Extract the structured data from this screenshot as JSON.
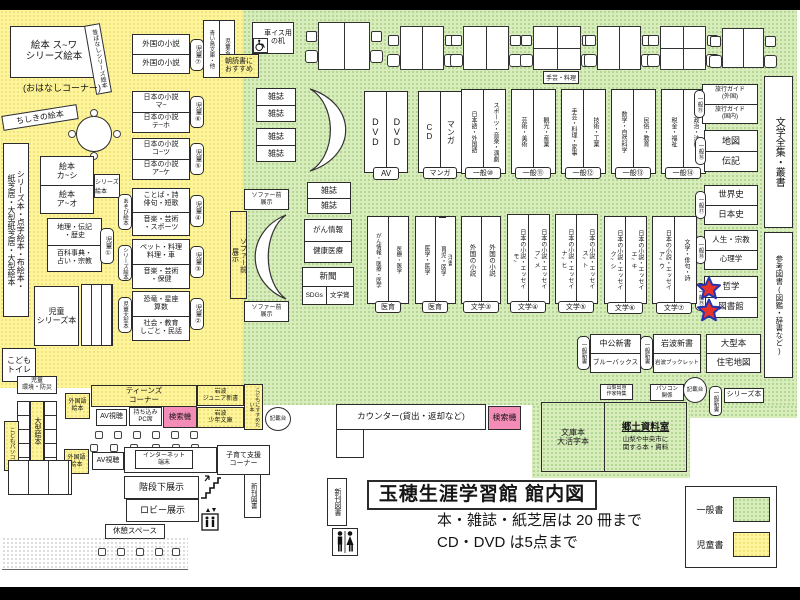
{
  "title": {
    "text": "玉穂生涯学習館 館内図",
    "rule_books": "本・雑誌・紙芝居は 20 冊まで",
    "rule_av": "CD・DVD は5点まで"
  },
  "legend": {
    "general_label": "一般書",
    "children_label": "児童書"
  },
  "colors": {
    "green_base": "#d8ecbc",
    "green_dot": "#a5cf85",
    "yellow_base": "#fdf49c",
    "yellow_dot": "#eede72",
    "search_pink": "#f48cb8",
    "star_fill": "#e8332b",
    "star_stroke": "#2433b0"
  },
  "kids": {
    "ehon_main": "絵本 ス~ワ\nシリーズ絵本",
    "ohanashi": "(おはなしコーナー)",
    "mukashi": "昔ばなしシリーズ絵本",
    "chishiki": "ちしきの絵本",
    "left_strip": "シリーズ本・点字絵本・布絵本・\n紙芝居・大型紙芝居・大型絵本",
    "ehon_pair": {
      "top": "絵本\nカ~シ",
      "bottom": "絵本\nア~オ",
      "tag": "シリーズ絵本"
    },
    "ref_pair": {
      "top": "地理・伝記\n・歴史",
      "bottom": "百科事典・\n占い・宗教",
      "tag": "児童①"
    },
    "series_box": "児童\nシリーズ本",
    "toilet": "こども\nトイレ",
    "env": "児童\n環境・防災",
    "ogata": "大型絵本",
    "pc": "こどもパソコン",
    "aoitori": "青い鳥文庫・他",
    "meisaku": "児童名作",
    "asadoku": "朝読書に\nおすすめ",
    "shelves": [
      {
        "top": "外国の小説",
        "bottom": "外国の小説",
        "tag": "児童⑦"
      },
      {
        "top": "日本の小説\nマ~",
        "bottom": "日本の小説\nテ~ホ",
        "tag": "児童⑥"
      },
      {
        "top": "日本の小説\nコ~ツ",
        "bottom": "日本の小説\nア~ケ",
        "tag": "児童⑤"
      },
      {
        "top": "ことば・詩\n俳句・短歌",
        "bottom": "音楽・芸術\n・スポーツ",
        "tag": "児童④",
        "side": "あそび絵本"
      },
      {
        "top": "ペット・料理\n料理・車",
        "bottom": "音楽・芸術\n・保健",
        "tag": "児童③",
        "side": "シリーズ絵本"
      },
      {
        "top": "恐竜・星座\n算数",
        "bottom": "社会・教育\nしごと・民話",
        "tag": "児童②",
        "side": "児童大型本"
      }
    ]
  },
  "sofa": {
    "front_display": "ソファー前\n展示"
  },
  "general": {
    "wheelchair_desk": "車イス用\nの机",
    "magazine": "雑誌",
    "cancer_info": "がん情報",
    "health": "健康医療",
    "newspaper": "新聞",
    "sdgs": "SDGs",
    "literary_prize": "文学賞",
    "craft_note": "手芸・料理",
    "columns": [
      {
        "left": "DVD",
        "right": "DVD",
        "label": "AV"
      },
      {
        "left": "CD",
        "right": "マンガ",
        "label": "マンガ"
      },
      {
        "left": "日本語・外国語",
        "right": "スポーツ・音楽・演劇",
        "label": "一般⑩"
      },
      {
        "left": "芸術・美術",
        "right": "観光・産業",
        "label": "一般⑪"
      },
      {
        "left": "手芸・料理・家事",
        "right": "技術・工業",
        "label": "一般⑫"
      },
      {
        "left": "数学・自然科学",
        "right": "民俗・教育",
        "label": "一般⑬"
      },
      {
        "left": "税金・福祉",
        "right": "政治・法律",
        "label": "一般⑭"
      }
    ],
    "wall_shelves": [
      {
        "top": "旅行ガイド\n(外国)",
        "bottom": "旅行ガイド\n(国内)",
        "tag": "一般⑮"
      },
      {
        "top": "地図",
        "bottom": "伝記",
        "tag": "一般⑯"
      },
      {
        "top": "世界史",
        "bottom": "日本史",
        "tag": "一般⑰"
      },
      {
        "top": "人生・宗教",
        "bottom": "心理学",
        "tag": "一般⑱"
      },
      {
        "top": "哲学",
        "bottom": "図書館",
        "tag": "一般⑲"
      }
    ],
    "literature_series": "文学全集・叢書",
    "reference": "参考図書(図鑑・辞書など)",
    "med_columns": [
      {
        "left": "がん情報・医療・医学",
        "right": "医療・医学",
        "label": "医育"
      },
      {
        "left": "医学・医学",
        "right_top": "洋書",
        "right_bottom": "育児・医学",
        "label": "医育"
      }
    ],
    "lit_columns": [
      {
        "left": "外国の小説",
        "right": "外国の小説",
        "label": "文学③"
      },
      {
        "left": "日本の小説・エッセイ\nモ~",
        "right": "日本の小説・エッセイ\nフ~メ",
        "label": "文学④"
      },
      {
        "left": "日本の小説・エッセイ\nナ~ヒ",
        "right": "日本の小説・エッセイ\nス~ト",
        "label": "文学⑤"
      },
      {
        "left": "日本の小説・エッセイ\nク~シ",
        "right": "日本の小説・エッセイ\nエ~キ",
        "label": "文学⑥"
      },
      {
        "left": "日本の小説・エッセイ\nア~ウ",
        "right": "文学・俳句・詩",
        "label": "文学⑦"
      }
    ],
    "shinsho": [
      {
        "tag": "一般新書",
        "top": "中公新書",
        "bottom": "ブルーバックス"
      },
      {
        "tag": "一般新書",
        "top": "岩波新書",
        "bottom": "岩波ブックレット"
      }
    ],
    "large_books": {
      "top": "大型本",
      "bottom": "住宅地図"
    },
    "yamanashi_feature": "山梨出身\n作家特集",
    "pc_related": "パソコン\n関係",
    "writing_desk": "記載台",
    "shinsho_tag": "一般新書",
    "series_books": "シリーズ本"
  },
  "service": {
    "counter": "カウンター(貸出・返却など)",
    "search": "検索機",
    "bunko": "文庫本\n大活字本",
    "local_room_title": "郷土資料室",
    "local_room_desc": "山梨や中央市に\n関する本・資料",
    "new_books": "新刊図書"
  },
  "teens": {
    "corner": "ティーンズ\nコーナー",
    "foreign_ehon": "外国語\n絵本",
    "av": "AV視聴",
    "byod": "持ち込み\nPC席",
    "iwanami_junior": "岩波\nジュニア新書",
    "iwanami_shonen": "岩波\n少年文庫",
    "recommend": "こどもにすすめたい本",
    "internet": "インターネット\n端末",
    "kosodate": "子育て支援\nコーナー"
  },
  "lobby": {
    "under_stairs": "階段下展示",
    "lobby_display": "ロビー展示",
    "rest": "休憩スペース"
  }
}
